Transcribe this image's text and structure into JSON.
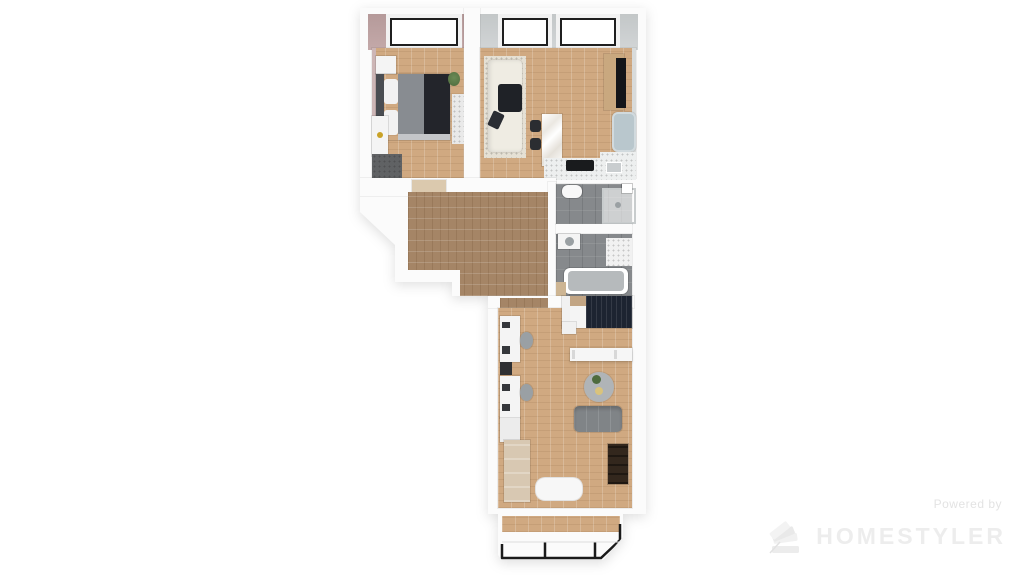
{
  "watermark": {
    "powered_by": "Powered by",
    "brand": "HOMESTYLER",
    "logo_icon": "homestyler-fan-logo"
  },
  "colors": {
    "canvas": "#ffffff",
    "wall": "#fbfbfb",
    "wall_edge": "#e0e0e0",
    "bedroom_wall": "#c4a9a9",
    "living_wall": "#d2d5d6",
    "floor_wood": "#d0a981",
    "floor_hall": "#a58566",
    "tile": "#86898c",
    "window_frame": "#1f1f1f",
    "bed_headboard": "#4a4d52",
    "bed_gray": "#888c91",
    "bed_dark": "#23252b",
    "sofa_cream": "#efece3",
    "cushion_dark": "#1f2227",
    "marble_white": "#f7f6f3",
    "stool_dark": "#2b2d31",
    "tv_black": "#141519",
    "tv_panel_wood": "#c9a87f",
    "armchair_blue": "#b9c7cd",
    "counter_white": "#edefef",
    "cooktop_black": "#191b1d",
    "navy_blanket": "#1d2431",
    "desk_white": "#f4f4f4",
    "chair_gray": "#9aa0a4",
    "cabinet_beige": "#d8c8b2",
    "sofa_gray": "#808487",
    "bookshelf_brown": "#33271d",
    "rug_round": "#b0b4b7",
    "rug_living": "#e5e0d4",
    "wardrobe_dark": "#606264",
    "mat_beige": "#cdb593",
    "gold": "#c9a227",
    "plant_green": "#4e6b3d",
    "balcony_frame": "#1a1a1a",
    "watermark_powered": "#e3e3e3",
    "watermark_brand": "#ededed"
  }
}
